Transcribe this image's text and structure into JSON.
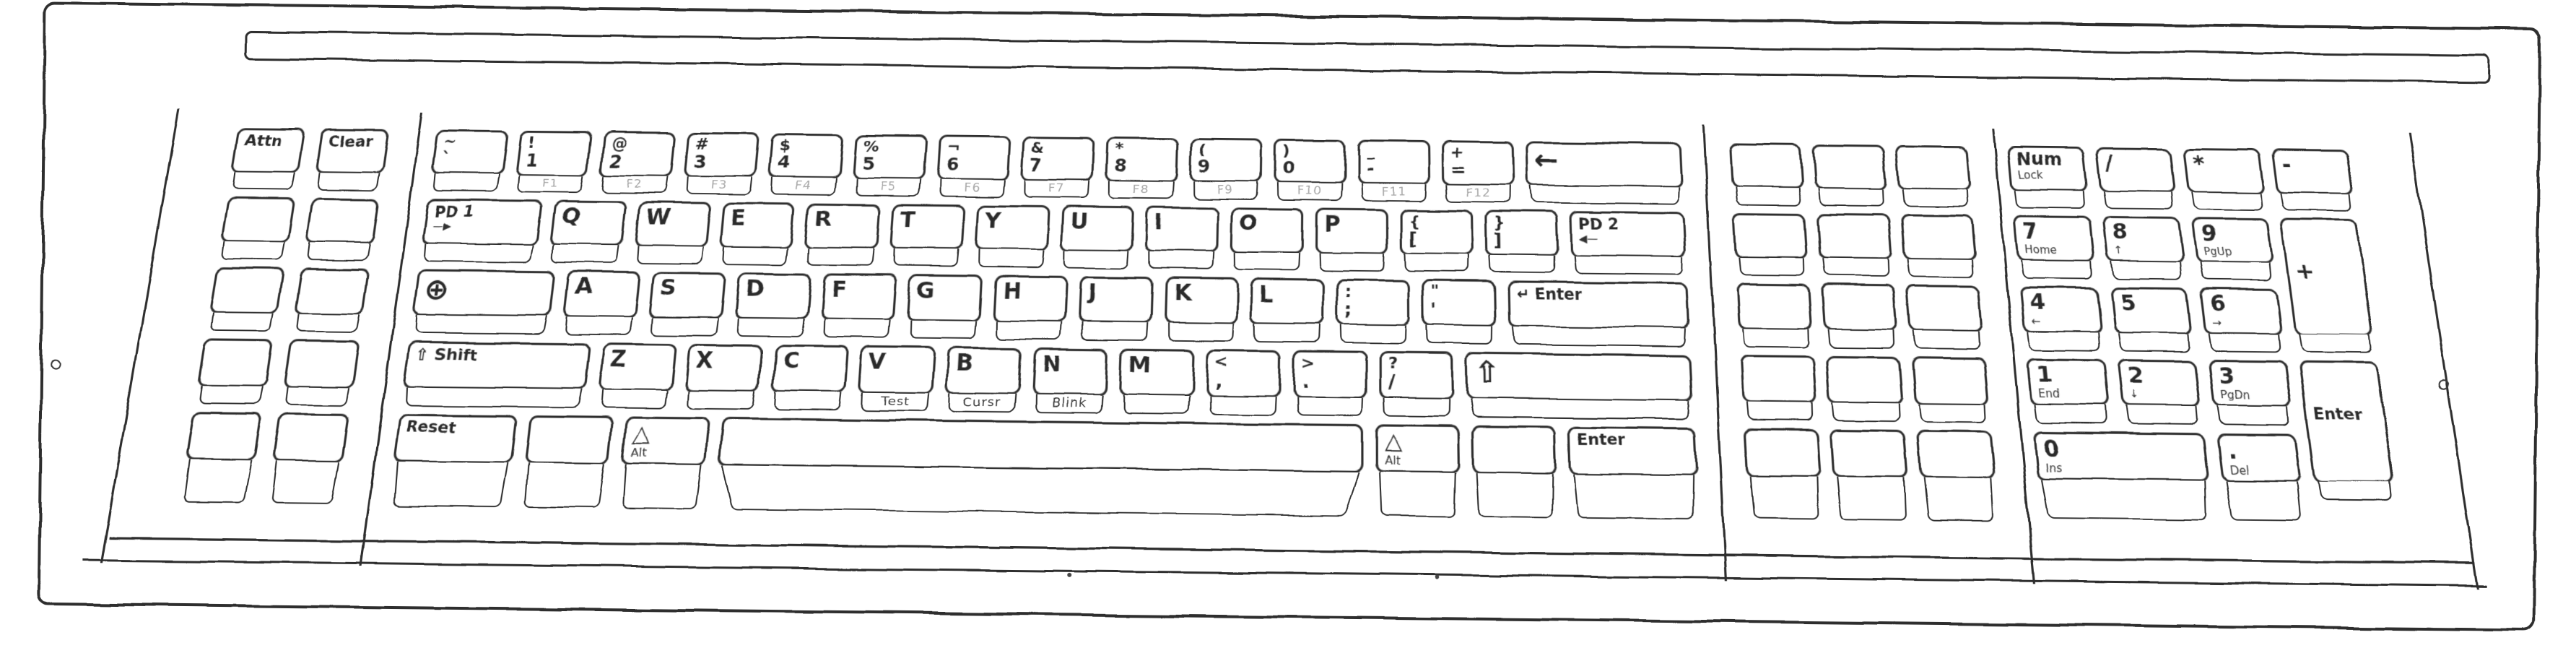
{
  "colors": {
    "paper": "#ffffff",
    "ink": "#2d2d2d",
    "ink_light": "#a8a8a8",
    "legend": "#2b2b2b"
  },
  "keyboard": {
    "left_block": {
      "rows": [
        [
          {
            "id": "attn",
            "label": "Attn"
          },
          {
            "id": "clear",
            "label": "Clear"
          }
        ],
        [
          {},
          {}
        ],
        [
          {},
          {}
        ],
        [
          {},
          {}
        ],
        [
          {},
          {}
        ]
      ]
    },
    "main_block": {
      "rows": [
        [
          {
            "id": "grave",
            "shift": "~",
            "label": "`"
          },
          {
            "id": "1",
            "shift": "!",
            "label": "1",
            "front": "F1"
          },
          {
            "id": "2",
            "shift": "@",
            "label": "2",
            "front": "F2"
          },
          {
            "id": "3",
            "shift": "#",
            "label": "3",
            "front": "F3"
          },
          {
            "id": "4",
            "shift": "$",
            "label": "4",
            "front": "F4"
          },
          {
            "id": "5",
            "shift": "%",
            "label": "5",
            "front": "F5"
          },
          {
            "id": "6",
            "shift": "¬",
            "label": "6",
            "front": "F6"
          },
          {
            "id": "7",
            "shift": "&",
            "label": "7",
            "front": "F7"
          },
          {
            "id": "8",
            "shift": "*",
            "label": "8",
            "front": "F8"
          },
          {
            "id": "9",
            "shift": "(",
            "label": "9",
            "front": "F9"
          },
          {
            "id": "0",
            "shift": ")",
            "label": "0",
            "front": "F10"
          },
          {
            "id": "minus",
            "shift": "_",
            "label": "-",
            "front": "F11"
          },
          {
            "id": "equals",
            "shift": "+",
            "label": "=",
            "front": "F12"
          },
          {
            "id": "backspace",
            "label": "←",
            "w": 2
          }
        ],
        [
          {
            "id": "pd1",
            "label": "PD 1",
            "sub": "—▶",
            "w": 1.5
          },
          {
            "id": "q",
            "label": "Q"
          },
          {
            "id": "w",
            "label": "W"
          },
          {
            "id": "e",
            "label": "E"
          },
          {
            "id": "r",
            "label": "R"
          },
          {
            "id": "t",
            "label": "T"
          },
          {
            "id": "y",
            "label": "Y"
          },
          {
            "id": "u",
            "label": "U"
          },
          {
            "id": "i",
            "label": "I"
          },
          {
            "id": "o",
            "label": "O"
          },
          {
            "id": "p",
            "label": "P"
          },
          {
            "id": "bracket-left",
            "shift": "{",
            "label": "["
          },
          {
            "id": "bracket-right",
            "shift": "}",
            "label": "]"
          },
          {
            "id": "pd2",
            "label": "PD 2",
            "sub": "◀—",
            "w": 1.5
          }
        ],
        [
          {
            "id": "shift-lock",
            "label": "⊕",
            "w": 1.75
          },
          {
            "id": "a",
            "label": "A"
          },
          {
            "id": "s",
            "label": "S"
          },
          {
            "id": "d",
            "label": "D"
          },
          {
            "id": "f",
            "label": "F"
          },
          {
            "id": "g",
            "label": "G"
          },
          {
            "id": "h",
            "label": "H"
          },
          {
            "id": "j",
            "label": "J"
          },
          {
            "id": "k",
            "label": "K"
          },
          {
            "id": "l",
            "label": "L"
          },
          {
            "id": "semicolon",
            "shift": ":",
            "label": ";"
          },
          {
            "id": "quote",
            "shift": "\"",
            "label": "'"
          },
          {
            "id": "enter",
            "label": "↵ Enter",
            "w": 2.25
          }
        ],
        [
          {
            "id": "shift-left",
            "label": "⇧ Shift",
            "w": 2.25
          },
          {
            "id": "z",
            "label": "Z"
          },
          {
            "id": "x",
            "label": "X"
          },
          {
            "id": "c",
            "label": "C"
          },
          {
            "id": "v",
            "label": "V",
            "front": "Test",
            "front_style": "dark"
          },
          {
            "id": "b",
            "label": "B",
            "front": "Cursr",
            "front_style": "dark"
          },
          {
            "id": "n",
            "label": "N",
            "front": "Blink",
            "front_style": "dark"
          },
          {
            "id": "m",
            "label": "M"
          },
          {
            "id": "comma",
            "shift": "<",
            "label": ","
          },
          {
            "id": "period",
            "shift": ">",
            "label": "."
          },
          {
            "id": "slash",
            "shift": "?",
            "label": "/"
          },
          {
            "id": "shift-right",
            "label": "⇧",
            "w": 2.75
          }
        ],
        [
          {
            "id": "reset",
            "label": "Reset",
            "w": 1.5
          },
          {
            "w": 1.1
          },
          {
            "id": "alt-left",
            "label": "△",
            "sub": "Alt",
            "w": 1.1
          },
          {
            "id": "space",
            "w": 7.5
          },
          {
            "id": "alt-right",
            "label": "△",
            "sub": "Alt",
            "w": 1.1
          },
          {
            "w": 1.1
          },
          {
            "id": "enter-bottom",
            "label": "Enter",
            "w": 1.6
          }
        ]
      ]
    },
    "pf_block": {
      "rows": [
        [
          {},
          {},
          {}
        ],
        [
          {},
          {},
          {}
        ],
        [
          {},
          {},
          {}
        ],
        [
          {},
          {},
          {}
        ],
        [
          {},
          {},
          {}
        ]
      ]
    },
    "numpad": {
      "keys": [
        {
          "id": "num-lock",
          "label": "Num",
          "sub": "Lock",
          "col": 1,
          "row": 1
        },
        {
          "id": "num-divide",
          "label": "/",
          "col": 2,
          "row": 1
        },
        {
          "id": "num-multiply",
          "label": "*",
          "col": 3,
          "row": 1
        },
        {
          "id": "num-minus",
          "label": "-",
          "col": 4,
          "row": 1
        },
        {
          "id": "num-7",
          "label": "7",
          "sub": "Home",
          "col": 1,
          "row": 2
        },
        {
          "id": "num-8",
          "label": "8",
          "sub": "↑",
          "col": 2,
          "row": 2
        },
        {
          "id": "num-9",
          "label": "9",
          "sub": "PgUp",
          "col": 3,
          "row": 2
        },
        {
          "id": "num-plus",
          "label": "+",
          "col": 4,
          "row": 2,
          "rowspan": 2
        },
        {
          "id": "num-4",
          "label": "4",
          "sub": "←",
          "col": 1,
          "row": 3
        },
        {
          "id": "num-5",
          "label": "5",
          "col": 2,
          "row": 3
        },
        {
          "id": "num-6",
          "label": "6",
          "sub": "→",
          "col": 3,
          "row": 3
        },
        {
          "id": "num-1",
          "label": "1",
          "sub": "End",
          "col": 1,
          "row": 4
        },
        {
          "id": "num-2",
          "label": "2",
          "sub": "↓",
          "col": 2,
          "row": 4
        },
        {
          "id": "num-3",
          "label": "3",
          "sub": "PgDn",
          "col": 3,
          "row": 4
        },
        {
          "id": "num-enter",
          "label": "Enter",
          "col": 4,
          "row": 4,
          "rowspan": 2
        },
        {
          "id": "num-0",
          "label": "0",
          "sub": "Ins",
          "col": 1,
          "row": 5,
          "colspan": 2
        },
        {
          "id": "num-period",
          "label": ".",
          "sub": "Del",
          "col": 3,
          "row": 5
        }
      ]
    }
  }
}
